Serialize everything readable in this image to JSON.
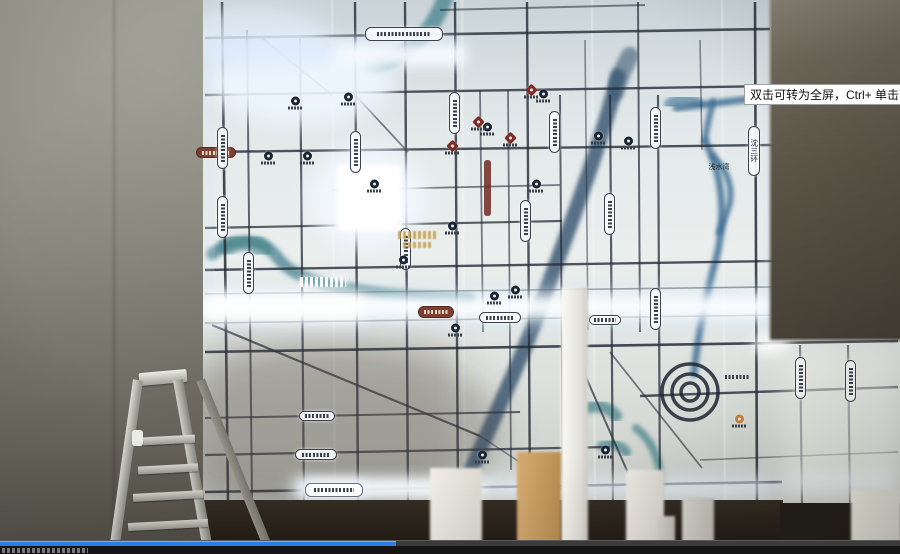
{
  "player": {
    "tooltip_text": "双击可转为全屏，Ctrl+ 单击可转为",
    "progress_fraction": 0.44,
    "progress_color": "#2d7de2",
    "seekbar_bg": "#3b3b3b",
    "controls_bg": "#141414"
  },
  "scene": {
    "left_wall_color": "#828176",
    "right_wall_color": "#5b5547",
    "ladder": "aluminum-stepladder",
    "pillars": [
      {
        "x": 561,
        "y": 288,
        "w": 27,
        "h": 266,
        "tone": "white-bright"
      },
      {
        "x": 430,
        "y": 468,
        "w": 52,
        "h": 86,
        "tone": "white"
      },
      {
        "x": 517,
        "y": 452,
        "w": 44,
        "h": 102,
        "tone": "tan"
      },
      {
        "x": 626,
        "y": 470,
        "w": 38,
        "h": 84,
        "tone": "white"
      },
      {
        "x": 682,
        "y": 498,
        "w": 32,
        "h": 56,
        "tone": "gray"
      },
      {
        "x": 851,
        "y": 490,
        "w": 50,
        "h": 64,
        "tone": "pale"
      },
      {
        "x": 657,
        "y": 516,
        "w": 18,
        "h": 38,
        "tone": "gray"
      }
    ]
  },
  "map": {
    "legible_labels": {
      "bay": "浅水湾",
      "ring_road": "沈三环"
    },
    "base_colors": {
      "panel": "#e9edec",
      "road": "#232b37",
      "river_teal": "#3d7b86",
      "river_blue": "#35536e",
      "glow": "#eef6ff"
    },
    "seams": [
      332,
      462,
      592,
      722
    ],
    "roads": [
      [
        440,
        10,
        645,
        5,
        2,
        0.55
      ],
      [
        205,
        38,
        770,
        29,
        2.6,
        0.8
      ],
      [
        205,
        95,
        772,
        86,
        2.4,
        0.8
      ],
      [
        205,
        152,
        772,
        145,
        2.4,
        0.8
      ],
      [
        332,
        190,
        560,
        185,
        1.8,
        0.6
      ],
      [
        205,
        228,
        562,
        221,
        2.2,
        0.75
      ],
      [
        205,
        270,
        772,
        261,
        2.4,
        0.8
      ],
      [
        205,
        294,
        772,
        287,
        1.6,
        0.55
      ],
      [
        205,
        323,
        775,
        315,
        1.6,
        0.55
      ],
      [
        205,
        352,
        898,
        341,
        2.6,
        0.85
      ],
      [
        640,
        396,
        898,
        387,
        2.4,
        0.8
      ],
      [
        205,
        418,
        520,
        412,
        2,
        0.7
      ],
      [
        205,
        455,
        610,
        447,
        2.2,
        0.75
      ],
      [
        205,
        492,
        782,
        482,
        2.6,
        0.85
      ],
      [
        700,
        460,
        898,
        452,
        1.6,
        0.5
      ],
      [
        222,
        2,
        228,
        500,
        2.6,
        0.85
      ],
      [
        247,
        30,
        252,
        500,
        2,
        0.7
      ],
      [
        300,
        38,
        304,
        505,
        2.2,
        0.75
      ],
      [
        355,
        2,
        358,
        505,
        2.4,
        0.8
      ],
      [
        405,
        2,
        408,
        505,
        2.4,
        0.8
      ],
      [
        455,
        2,
        458,
        505,
        2.4,
        0.8
      ],
      [
        480,
        90,
        483,
        332,
        1.8,
        0.6
      ],
      [
        508,
        90,
        511,
        470,
        1.8,
        0.6
      ],
      [
        527,
        2,
        530,
        505,
        2.4,
        0.8
      ],
      [
        560,
        95,
        563,
        505,
        2,
        0.7
      ],
      [
        585,
        40,
        588,
        330,
        1.6,
        0.5
      ],
      [
        610,
        95,
        613,
        505,
        2.2,
        0.75
      ],
      [
        638,
        2,
        640,
        332,
        2,
        0.7
      ],
      [
        658,
        95,
        660,
        505,
        2.2,
        0.75
      ],
      [
        700,
        40,
        702,
        150,
        1.6,
        0.5
      ],
      [
        755,
        2,
        757,
        500,
        2.6,
        0.85
      ],
      [
        800,
        345,
        802,
        505,
        2.2,
        0.7
      ],
      [
        848,
        345,
        850,
        505,
        2.2,
        0.7
      ],
      [
        212,
        325,
        480,
        436,
        2.2,
        0.75
      ],
      [
        262,
        38,
        332,
        95,
        1.8,
        0.6
      ],
      [
        355,
        95,
        408,
        152,
        1.8,
        0.6
      ],
      [
        575,
        352,
        642,
        505,
        2,
        0.7
      ],
      [
        610,
        352,
        702,
        468,
        1.8,
        0.6
      ],
      [
        480,
        436,
        585,
        505,
        1.6,
        0.5
      ]
    ],
    "rivers": [
      {
        "d": "M446,-4 C436,22 424,40 402,54 C392,60 382,64 372,66",
        "w": 16,
        "c": "#45828d",
        "o": 0.75
      },
      {
        "d": "M212,254 C240,234 264,240 278,258 C294,280 336,294 470,299",
        "w": 12,
        "c": "#3d7b86",
        "o": 0.7
      },
      {
        "d": "M228,246 C240,238 254,240 262,250",
        "w": 20,
        "c": "#3d7b86",
        "o": 0.5
      },
      {
        "d": "M618,76 C600,150 560,252 541,305 C523,357 492,420 468,478",
        "w": 15,
        "c": "#35536e",
        "o": 0.8
      },
      {
        "d": "M630,56 C622,70 618,80 615,92",
        "w": 18,
        "c": "#3b5a74",
        "o": 0.6
      },
      {
        "d": "M676,108 L750,99",
        "w": 7,
        "c": "#3e6e93",
        "o": 0.85
      },
      {
        "d": "M713,101 C709,118 706,130 705,141",
        "w": 6,
        "c": "#3e6e93",
        "o": 0.85
      },
      {
        "d": "M705,141 C723,174 728,222 713,270 C705,302 697,340 694,374",
        "w": 7,
        "c": "#3e6e93",
        "o": 0.85
      },
      {
        "d": "M713,156 C729,172 735,192 727,212 L719,233",
        "w": 6,
        "c": "#3e6e93",
        "o": 0.85
      },
      {
        "d": "M670,104 C678,98 690,98 698,104",
        "w": 12,
        "c": "#3e6e93",
        "o": 0.6
      },
      {
        "d": "M586,408 C598,404 610,408 616,416",
        "w": 12,
        "c": "#3f7f86",
        "o": 0.7
      },
      {
        "d": "M602,446 C612,442 622,446 626,452",
        "w": 10,
        "c": "#3f7f86",
        "o": 0.7
      },
      {
        "d": "M636,428 C656,444 664,470 658,496",
        "w": 8,
        "c": "#3f7f86",
        "o": 0.7
      }
    ],
    "metro": {
      "x": 484,
      "y": 160,
      "w": 7,
      "h": 56,
      "color": "#6e2a22"
    },
    "ring_interchange": {
      "cx": 690,
      "cy": 392,
      "radii": [
        28,
        18,
        9
      ],
      "stroke": "#1d2531"
    },
    "overlays": [
      {
        "t": "e",
        "x": 330,
        "y": 430,
        "rx": 175,
        "ry": 85,
        "f": "#4a443c",
        "o": 0.28,
        "b": 16
      },
      {
        "t": "r",
        "x": 203,
        "y": 335,
        "w": 250,
        "h": 170,
        "f": "#5a544a",
        "o": 0.18,
        "b": 16
      },
      {
        "t": "e",
        "x": 300,
        "y": 82,
        "rx": 95,
        "ry": 42,
        "f": "#eef6ff",
        "o": 0.9,
        "b": 10
      },
      {
        "t": "e",
        "x": 252,
        "y": 38,
        "rx": 75,
        "ry": 30,
        "f": "#e2eefb",
        "o": 0.7,
        "b": 10
      },
      {
        "t": "e",
        "x": 368,
        "y": 198,
        "rx": 58,
        "ry": 50,
        "f": "#f2f8ff",
        "o": 0.95,
        "b": 10
      },
      {
        "t": "r",
        "x": 337,
        "y": 165,
        "w": 64,
        "h": 66,
        "f": "#ffffff",
        "o": 1,
        "b": 2
      },
      {
        "t": "r",
        "x": 203,
        "y": 290,
        "w": 577,
        "h": 34,
        "f": "#d9ebfb",
        "o": 0.55,
        "b": 10
      },
      {
        "t": "r",
        "x": 203,
        "y": 297,
        "w": 577,
        "h": 20,
        "f": "#fcfeff",
        "o": 0.95,
        "b": 6
      },
      {
        "t": "r",
        "x": 203,
        "y": 294,
        "w": 160,
        "h": 26,
        "f": "#ffffff",
        "o": 0.9,
        "b": 6
      },
      {
        "t": "r",
        "x": 292,
        "y": 479,
        "w": 480,
        "h": 17,
        "f": "#e8f2fd",
        "o": 0.85,
        "b": 8
      },
      {
        "t": "r",
        "x": 298,
        "y": 481,
        "w": 185,
        "h": 15,
        "f": "#fdfeff",
        "o": 0.95,
        "b": 6
      },
      {
        "t": "r",
        "x": 206,
        "y": 41,
        "w": 252,
        "h": 18,
        "f": "#dcebfb",
        "o": 0.8,
        "b": 8
      },
      {
        "t": "r",
        "x": 336,
        "y": 45,
        "w": 130,
        "h": 21,
        "f": "#f6faff",
        "o": 0.95,
        "b": 6
      },
      {
        "t": "e",
        "x": 772,
        "y": 344,
        "rx": 20,
        "ry": 11,
        "f": "#ffffff",
        "o": 0.9,
        "b": 6
      },
      {
        "t": "r",
        "x": 782,
        "y": 473,
        "w": 112,
        "h": 15,
        "f": "#dfeefb",
        "o": 0.8,
        "b": 8
      },
      {
        "t": "r",
        "x": 766,
        "y": 118,
        "w": 8,
        "h": 214,
        "f": "#cfe2f4",
        "o": 0.5,
        "b": 6
      },
      {
        "t": "r",
        "x": 204,
        "y": 60,
        "w": 6,
        "h": 240,
        "f": "#d6e7f7",
        "o": 0.5,
        "b": 6
      },
      {
        "t": "r",
        "x": 782,
        "y": 350,
        "w": 116,
        "h": 150,
        "f": "#f4f3ee",
        "o": 0.5,
        "b": 10
      }
    ],
    "labels": [
      {
        "x": 365,
        "y": 27,
        "w": 78,
        "h": 14,
        "o": "h",
        "s": "w",
        "t": ""
      },
      {
        "x": 196,
        "y": 147,
        "w": 40,
        "h": 11,
        "o": "h",
        "s": "m",
        "t": ""
      },
      {
        "x": 418,
        "y": 306,
        "w": 36,
        "h": 12,
        "o": "h",
        "s": "m",
        "t": ""
      },
      {
        "x": 479,
        "y": 312,
        "w": 42,
        "h": 11,
        "o": "h",
        "s": "w",
        "t": ""
      },
      {
        "x": 299,
        "y": 411,
        "w": 36,
        "h": 10,
        "o": "h",
        "s": "w",
        "t": ""
      },
      {
        "x": 295,
        "y": 449,
        "w": 42,
        "h": 11,
        "o": "h",
        "s": "w",
        "t": ""
      },
      {
        "x": 305,
        "y": 483,
        "w": 58,
        "h": 14,
        "o": "h",
        "s": "g",
        "t": ""
      },
      {
        "x": 589,
        "y": 315,
        "w": 32,
        "h": 10,
        "o": "h",
        "s": "w",
        "t": ""
      },
      {
        "x": 720,
        "y": 372,
        "w": 34,
        "h": 10,
        "o": "h",
        "s": "t",
        "t": ""
      },
      {
        "x": 700,
        "y": 162,
        "w": 38,
        "h": 10,
        "o": "h",
        "s": "t",
        "t": "浅水湾"
      },
      {
        "x": 217,
        "y": 127,
        "w": 11,
        "h": 42,
        "o": "v",
        "s": "w",
        "t": ""
      },
      {
        "x": 217,
        "y": 196,
        "w": 11,
        "h": 42,
        "o": "v",
        "s": "w",
        "t": ""
      },
      {
        "x": 243,
        "y": 252,
        "w": 11,
        "h": 42,
        "o": "v",
        "s": "w",
        "t": ""
      },
      {
        "x": 350,
        "y": 131,
        "w": 11,
        "h": 42,
        "o": "v",
        "s": "w",
        "t": ""
      },
      {
        "x": 400,
        "y": 228,
        "w": 11,
        "h": 42,
        "o": "v",
        "s": "w",
        "t": ""
      },
      {
        "x": 449,
        "y": 92,
        "w": 11,
        "h": 42,
        "o": "v",
        "s": "w",
        "t": ""
      },
      {
        "x": 520,
        "y": 200,
        "w": 11,
        "h": 42,
        "o": "v",
        "s": "w",
        "t": ""
      },
      {
        "x": 549,
        "y": 111,
        "w": 11,
        "h": 42,
        "o": "v",
        "s": "w",
        "t": ""
      },
      {
        "x": 604,
        "y": 193,
        "w": 11,
        "h": 42,
        "o": "v",
        "s": "w",
        "t": ""
      },
      {
        "x": 650,
        "y": 107,
        "w": 11,
        "h": 42,
        "o": "v",
        "s": "w",
        "t": ""
      },
      {
        "x": 650,
        "y": 288,
        "w": 11,
        "h": 42,
        "o": "v",
        "s": "w",
        "t": ""
      },
      {
        "x": 795,
        "y": 357,
        "w": 11,
        "h": 42,
        "o": "v",
        "s": "w",
        "t": ""
      },
      {
        "x": 845,
        "y": 360,
        "w": 11,
        "h": 42,
        "o": "v",
        "s": "w",
        "t": ""
      },
      {
        "x": 575,
        "y": 362,
        "w": 11,
        "h": 42,
        "o": "v",
        "s": "w",
        "t": ""
      },
      {
        "x": 748,
        "y": 126,
        "w": 12,
        "h": 50,
        "o": "v",
        "s": "w",
        "t": "沈三环"
      }
    ],
    "pois": {
      "navy": [
        [
          295,
          103
        ],
        [
          348,
          99
        ],
        [
          374,
          186
        ],
        [
          403,
          262
        ],
        [
          452,
          228
        ],
        [
          487,
          129
        ],
        [
          494,
          298
        ],
        [
          515,
          292
        ],
        [
          536,
          186
        ],
        [
          598,
          138
        ],
        [
          628,
          143
        ],
        [
          268,
          158
        ],
        [
          307,
          158
        ],
        [
          455,
          330
        ],
        [
          482,
          457
        ],
        [
          543,
          96
        ],
        [
          573,
          452
        ],
        [
          605,
          452
        ]
      ],
      "maroon": [
        [
          478,
          124
        ],
        [
          510,
          140
        ],
        [
          531,
          92
        ],
        [
          452,
          148
        ]
      ],
      "orange": [
        [
          739,
          421
        ]
      ]
    },
    "accent_texts": [
      {
        "x": 398,
        "y": 231,
        "w": 40,
        "h": 8,
        "c": "gold"
      },
      {
        "x": 403,
        "y": 242,
        "w": 30,
        "h": 6,
        "c": "gold"
      },
      {
        "x": 300,
        "y": 277,
        "w": 46,
        "h": 10,
        "c": "white"
      }
    ]
  }
}
